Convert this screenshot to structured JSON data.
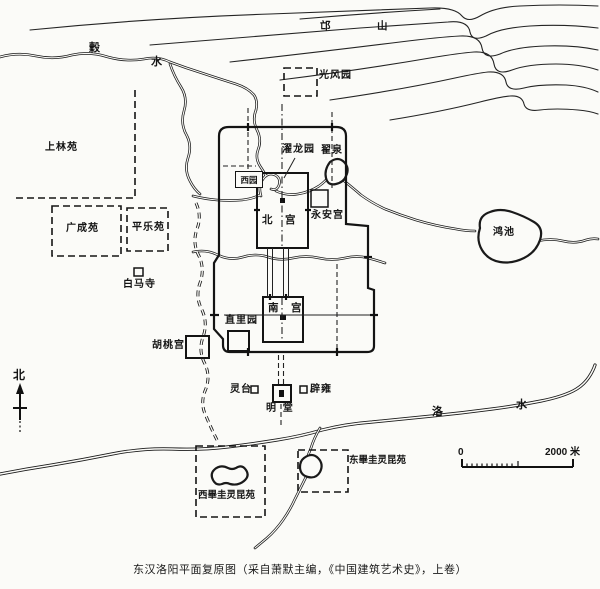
{
  "caption": "东汉洛阳平面复原图（采自萧默主编，《中国建筑艺术史》，上卷）",
  "compass": {
    "north": "北"
  },
  "scale_bar": {
    "zero": "0",
    "max": "2000 米"
  },
  "mountain": {
    "name": "邙　山"
  },
  "rivers": {
    "gu_char1": "穀",
    "gu_char2": "水",
    "luo_char1": "洛",
    "luo_char2": "水"
  },
  "sites": {
    "guangfengyuan": "光风园",
    "shanglinyuan": "上林苑",
    "guangchengyuan": "广成苑",
    "pingleyuan": "平乐苑",
    "baimasi": "白马寺",
    "xiyuan": "西园",
    "zhuolongyuan": "濯龙园",
    "zhaiquan": "翟泉",
    "yonganggong": "永安宫",
    "beigong": "北　宫",
    "nangong": "南　宫",
    "zhiliyuan": "直里园",
    "hutaogong": "胡桃宫",
    "hongchi": "鸿池",
    "lingtai": "灵台",
    "biyong": "辟雍",
    "mingtang": "明 堂",
    "xi_biguilingkunyuan": "西畢圭灵昆苑",
    "dong_biguilingkunyuan": "东畢圭灵昆苑"
  },
  "colors": {
    "ink": "#1a1a1a",
    "paper": "#fbfbf8"
  }
}
